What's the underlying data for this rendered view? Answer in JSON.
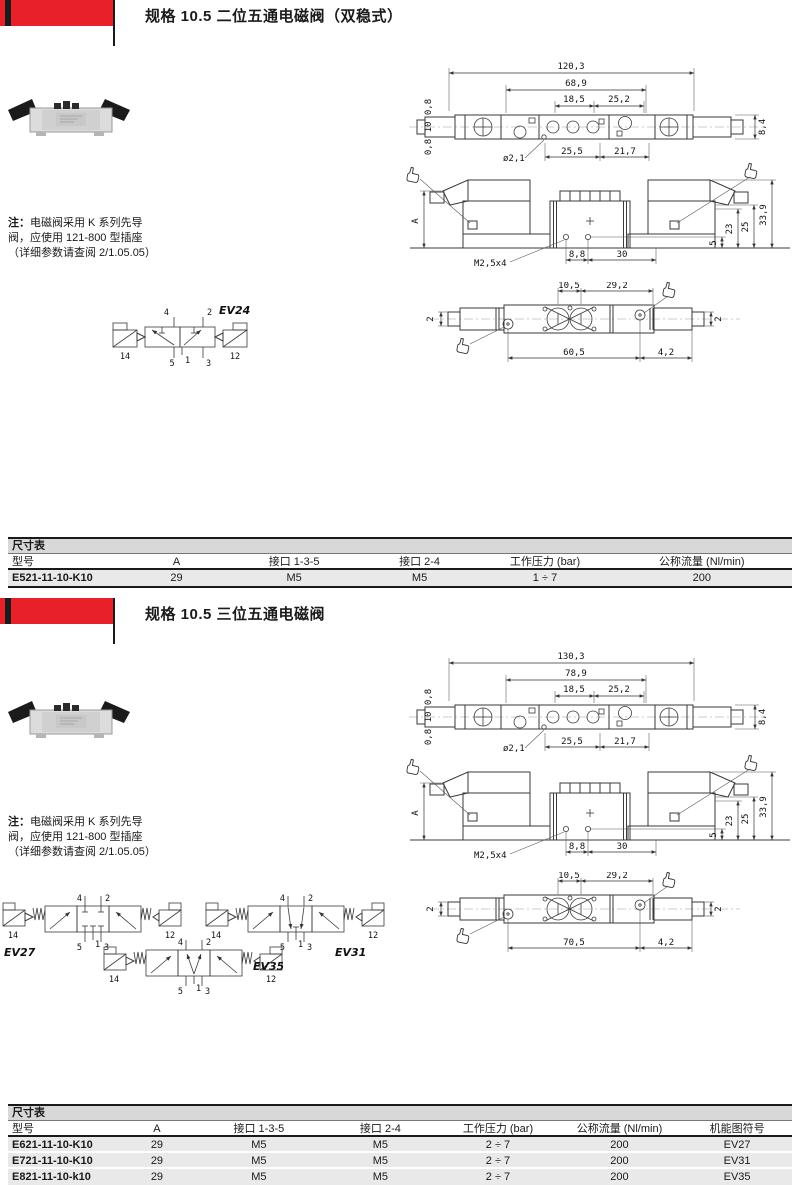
{
  "accent": "#e8202a",
  "s1": {
    "title": "规格 10.5 二位五通电磁阀（双稳式）",
    "note": {
      "prefix": "注：",
      "body": "电磁阀采用 K 系列先导阀，应使用 121-800 型插座（详细参数请查阅 2/1.05.05）"
    },
    "top": {
      "total": "120,3",
      "body": "68,9",
      "a": "18,5",
      "b": "25,2",
      "e1": "0,8",
      "e2": "10",
      "e3": "0,8",
      "hole": "ø2,1",
      "c": "25,5",
      "d": "21,7",
      "right": "8,4"
    },
    "front": {
      "a": "A",
      "h1": "33,9",
      "h2": "25",
      "h3": "23",
      "h4": "5",
      "thread": "M2,5x4",
      "w1": "8,8",
      "w2": "30"
    },
    "bottom": {
      "t1": "10,5",
      "t2": "29,2",
      "left": "2",
      "right": "2",
      "b1": "60,5",
      "b2": "4,2"
    },
    "sym": {
      "label": "EV24",
      "p4": "4",
      "p2": "2",
      "p5": "5",
      "p1": "1",
      "p3": "3",
      "p14": "14",
      "p12": "12"
    }
  },
  "t1": {
    "caption": "尺寸表",
    "headers": [
      "型号",
      "A",
      "接口 1-3-5",
      "接口 2-4",
      "工作压力 (bar)",
      "公称流量 (Nl/min)"
    ],
    "rows": [
      [
        "E521-11-10-K10",
        "29",
        "M5",
        "M5",
        "1 ÷ 7",
        "200"
      ]
    ]
  },
  "s2": {
    "title": "规格 10.5 三位五通电磁阀",
    "note": {
      "prefix": "注：",
      "body": "电磁阀采用 K 系列先导阀，应使用 121-800 型插座（详细参数请查阅 2/1.05.05）"
    },
    "top": {
      "total": "130,3",
      "body": "78,9",
      "a": "18,5",
      "b": "25,2",
      "e1": "0,8",
      "e2": "10",
      "e3": "0,8",
      "hole": "ø2,1",
      "c": "25,5",
      "d": "21,7",
      "right": "8,4"
    },
    "front": {
      "a": "A",
      "h1": "33,9",
      "h2": "25",
      "h3": "23",
      "h4": "5",
      "thread": "M2,5x4",
      "w1": "8,8",
      "w2": "30"
    },
    "bottom": {
      "t1": "10,5",
      "t2": "29,2",
      "left": "2",
      "right": "2",
      "b1": "70,5",
      "b2": "4,2"
    },
    "sym27": {
      "label": "EV27",
      "p4": "4",
      "p2": "2",
      "p5": "5",
      "p1": "1",
      "p3": "3",
      "p14": "14",
      "p12": "12"
    },
    "sym31": {
      "label": "EV31",
      "p4": "4",
      "p2": "2",
      "p5": "5",
      "p1": "1",
      "p3": "3",
      "p14": "14",
      "p12": "12"
    },
    "sym35": {
      "label": "EV35",
      "p4": "4",
      "p2": "2",
      "p5": "5",
      "p1": "1",
      "p3": "3",
      "p14": "14",
      "p12": "12"
    }
  },
  "t2": {
    "caption": "尺寸表",
    "headers": [
      "型号",
      "A",
      "接口 1-3-5",
      "接口 2-4",
      "工作压力 (bar)",
      "公称流量 (Nl/min)",
      "机能图符号"
    ],
    "rows": [
      [
        "E621-11-10-K10",
        "29",
        "M5",
        "M5",
        "2 ÷ 7",
        "200",
        "EV27"
      ],
      [
        "E721-11-10-K10",
        "29",
        "M5",
        "M5",
        "2 ÷ 7",
        "200",
        "EV31"
      ],
      [
        "E821-11-10-k10",
        "29",
        "M5",
        "M5",
        "2 ÷ 7",
        "200",
        "EV35"
      ]
    ]
  }
}
